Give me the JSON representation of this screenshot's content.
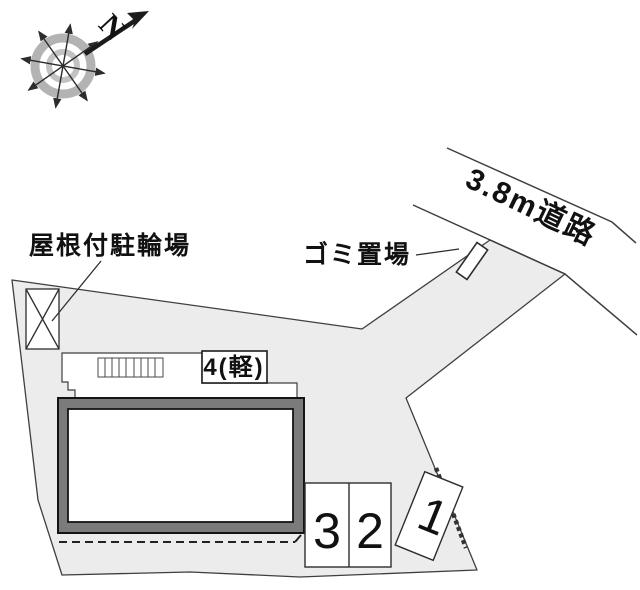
{
  "plan": {
    "compass": {
      "north_label": "N"
    },
    "road": {
      "label": "3.8m道路"
    },
    "labels": {
      "covered_bicycle_parking": "屋根付駐輪場",
      "garbage_area": "ゴミ置場"
    },
    "parking_spaces": {
      "space_4": "4(軽)",
      "space_3": "3",
      "space_2": "2",
      "space_1": "1"
    },
    "colors": {
      "site_fill": "#ececec",
      "building_band": "#7b7b7b",
      "outline": "#3f3f3f",
      "compass_ring": "#b3b3b3"
    }
  }
}
